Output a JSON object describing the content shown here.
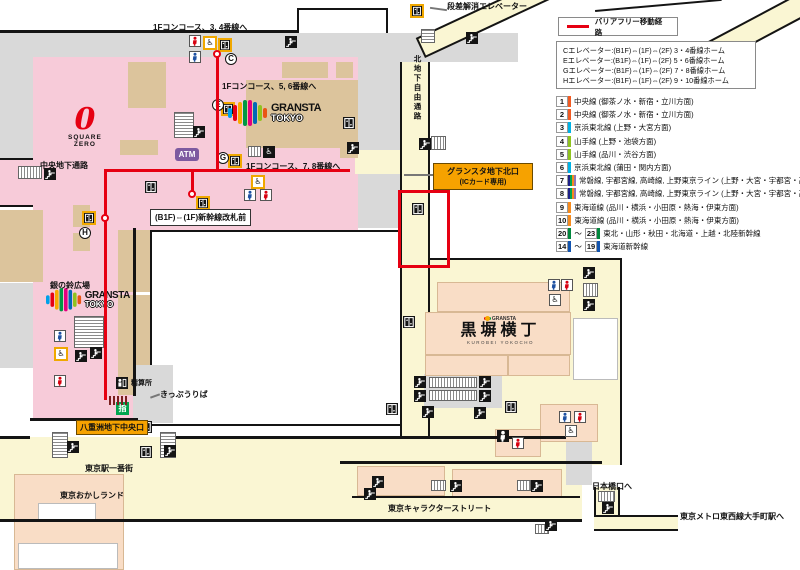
{
  "colors": {
    "route_red": "#e60012",
    "highlight_red": "#e60012",
    "zone_pink": "#f7cbd9",
    "zone_cream": "#faf6d3",
    "zone_tan": "#dcc49c",
    "zone_peach": "#f9ddc6",
    "zone_gray": "#d9d9d9",
    "label_orange": "#f6a200",
    "atm_purple": "#7d5aa0",
    "green_window_green": "#00a54f",
    "gransta_logo_colors": [
      "#00a0e9",
      "#e60012",
      "#f6aa00",
      "#009944",
      "#e4007f",
      "#0068b7",
      "#8fc31f",
      "#ea5514"
    ]
  },
  "legend": {
    "route_label": "バリアフリー移動経路",
    "elevator_list": [
      "Cエレベーター:(B1F)⇔(1F)⇔(2F) 3・4番線ホーム",
      "Eエレベーター:(B1F)⇔(1F)⇔(2F) 5・6番線ホーム",
      "Gエレベーター:(B1F)⇔(1F)⇔(2F) 7・8番線ホーム",
      "Hエレベーター:(B1F)⇔(1F)⇔(2F) 9・10番線ホーム"
    ],
    "lines": [
      {
        "nums": [
          "1"
        ],
        "colors": [
          "#f15a22"
        ],
        "label": "中央線 (御茶ノ水・新宿・立川方面)"
      },
      {
        "nums": [
          "2"
        ],
        "colors": [
          "#f15a22"
        ],
        "label": "中央線 (御茶ノ水・新宿・立川方面)"
      },
      {
        "nums": [
          "3"
        ],
        "colors": [
          "#00b2e5"
        ],
        "label": "京浜東北線 (上野・大宮方面)"
      },
      {
        "nums": [
          "4"
        ],
        "colors": [
          "#8fc31f"
        ],
        "label": "山手線 (上野・池袋方面)"
      },
      {
        "nums": [
          "5"
        ],
        "colors": [
          "#8fc31f"
        ],
        "label": "山手線 (品川・渋谷方面)"
      },
      {
        "nums": [
          "6"
        ],
        "colors": [
          "#00b2e5"
        ],
        "label": "京浜東北線 (蒲田・関内方面)"
      },
      {
        "nums": [
          "7"
        ],
        "colors": [
          "#1d2088",
          "#00a650",
          "#f68b1e",
          "#8f76b5"
        ],
        "label": "常磐線, 宇都宮線, 高崎線, 上野東京ライン (上野・大宮・宇都宮・高崎方面)"
      },
      {
        "nums": [
          "8"
        ],
        "colors": [
          "#1d2088",
          "#00a650",
          "#f68b1e",
          "#8f76b5"
        ],
        "label": "常磐線, 宇都宮線, 高崎線, 上野東京ライン (上野・大宮・宇都宮・高崎方面)"
      },
      {
        "nums": [
          "9"
        ],
        "colors": [
          "#f68b1e"
        ],
        "label": "東海道線 (品川・横浜・小田原・熱海・伊東方面)"
      },
      {
        "nums": [
          "10"
        ],
        "colors": [
          "#f68b1e"
        ],
        "label": "東海道線 (品川・横浜・小田原・熱海・伊東方面)"
      },
      {
        "nums": [
          "20",
          "23"
        ],
        "colors": [
          "#00873c"
        ],
        "label": "東北・山形・秋田・北海道・上越・北陸新幹線"
      },
      {
        "nums": [
          "14",
          "19"
        ],
        "colors": [
          "#1153af"
        ],
        "label": "東海道新幹線"
      }
    ]
  },
  "map": {
    "labels": {
      "concourse34": "1Fコンコース、3, 4番線へ",
      "concourse56": "1Fコンコース、5, 6番線へ",
      "concourse78": "1Fコンコース、7, 8番線へ",
      "shinkansen_gate": "(B1F)⇔(1F)新幹線改札前",
      "chuo_underpass": "中央地下通路",
      "north_passage": "北地下自由通路",
      "step_free_elevator": "段差解消エレベーター",
      "gransta_north_exit_1": "グランスタ地下北口",
      "gransta_north_exit_2": "(ICカード専用)",
      "suzu_plaza": "銀の鈴広場",
      "fare_office": "精算所",
      "ticket_office": "きっぷうりば",
      "yaesu_exit": "八重洲地下中央口",
      "ichibangai": "東京駅一番街",
      "okashi_land": "東京おかしランド",
      "kurobei": "黒塀横丁",
      "kurobei_sub": "KUROBEI YOKOCHO",
      "character_street": "東京キャラクターストリート",
      "nihonbashi_exit": "日本橋口へ",
      "tozai_line": "東京メトロ東西線大手町駅へ"
    },
    "badges": {
      "c": "C",
      "e": "E",
      "g": "G",
      "h": "H"
    },
    "logos": {
      "gransta_line1": "GRANSTA",
      "gransta_line2": "TOKYO",
      "square_zero_zero": "0",
      "square_zero_line1": "SQUARE",
      "square_zero_line2": "ZERO",
      "atm": "ATM",
      "green_window": "指",
      "kurobei_logo": "GRANSTA"
    },
    "icon_glyphs": {
      "elevator-icon": "box-with-doors glyph",
      "escalator-icon": "person-on-steps glyph",
      "stairs-icon": "hatched rectangle",
      "male-restroom-icon": "blue person",
      "female-restroom-icon": "red person",
      "wheelchair-icon": "♿",
      "fare-office-icon": "person-at-counter",
      "green-window-icon": "指"
    }
  }
}
